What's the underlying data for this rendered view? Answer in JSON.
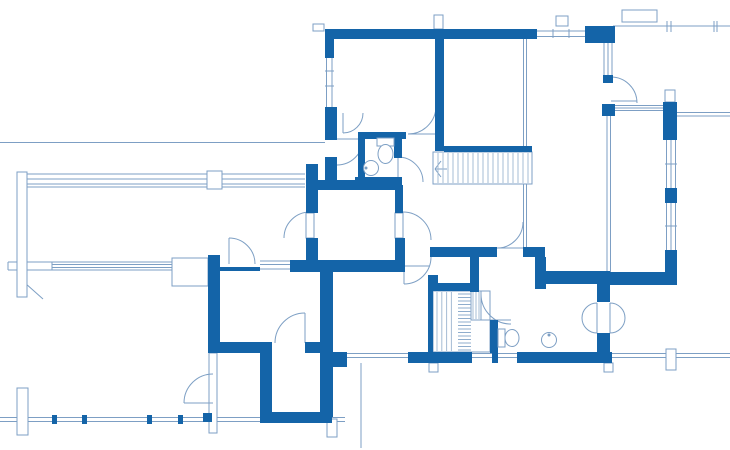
{
  "document": {
    "type": "architectural-floor-plan",
    "canvas": {
      "width": 730,
      "height": 450
    },
    "colors": {
      "background": "#ffffff",
      "wall": "#1464a8",
      "line": "#7d9fc4",
      "hatch": "#a5bcd4",
      "hatch_dense": "#8fadcd",
      "fixture": "#7d9fc4"
    }
  },
  "plan": {
    "walls": [
      [
        325,
        29,
        212,
        10
      ],
      [
        585,
        26,
        30,
        17
      ],
      [
        600,
        27,
        15,
        16
      ],
      [
        325,
        29,
        9,
        29
      ],
      [
        325,
        107,
        12,
        33
      ],
      [
        325,
        157,
        12,
        30
      ],
      [
        435,
        31,
        9,
        120
      ],
      [
        444,
        146,
        88,
        6
      ],
      [
        358,
        132,
        48,
        7
      ],
      [
        358,
        132,
        7,
        53
      ],
      [
        394,
        132,
        8,
        26
      ],
      [
        355,
        177,
        47,
        8
      ],
      [
        306,
        164,
        12,
        49
      ],
      [
        306,
        238,
        12,
        26
      ],
      [
        310,
        180,
        92,
        10
      ],
      [
        395,
        185,
        8,
        28
      ],
      [
        395,
        238,
        10,
        34
      ],
      [
        290,
        260,
        113,
        12
      ],
      [
        208,
        255,
        12,
        17
      ],
      [
        218,
        267,
        42,
        4
      ],
      [
        208,
        258,
        12,
        95
      ],
      [
        320,
        268,
        13,
        149
      ],
      [
        208,
        342,
        64,
        11
      ],
      [
        305,
        342,
        28,
        11
      ],
      [
        260,
        353,
        12,
        70
      ],
      [
        260,
        412,
        72,
        11
      ],
      [
        430,
        247,
        67,
        10
      ],
      [
        523,
        247,
        22,
        10
      ],
      [
        535,
        257,
        11,
        32
      ],
      [
        545,
        271,
        65,
        13
      ],
      [
        597,
        284,
        13,
        18
      ],
      [
        597,
        333,
        13,
        29
      ],
      [
        610,
        272,
        65,
        13
      ],
      [
        470,
        257,
        9,
        35
      ],
      [
        428,
        275,
        10,
        16
      ],
      [
        428,
        290,
        5,
        62
      ],
      [
        433,
        283,
        37,
        8
      ],
      [
        490,
        320,
        8,
        33
      ],
      [
        408,
        352,
        64,
        11
      ],
      [
        492,
        352,
        6,
        11
      ],
      [
        517,
        352,
        95,
        11
      ],
      [
        332,
        352,
        15,
        15
      ],
      [
        603,
        75,
        10,
        8
      ],
      [
        602,
        104,
        13,
        12
      ],
      [
        663,
        102,
        14,
        38
      ],
      [
        665,
        188,
        12,
        15
      ],
      [
        665,
        250,
        12,
        35
      ],
      [
        52,
        415,
        5,
        9
      ],
      [
        82,
        415,
        5,
        9
      ],
      [
        147,
        415,
        5,
        9
      ],
      [
        178,
        415,
        5,
        9
      ],
      [
        203,
        413,
        9,
        9
      ]
    ],
    "thin_lines": [
      [
        0,
        142.5,
        325,
        142.5
      ],
      [
        326.5,
        58,
        326.5,
        107
      ],
      [
        332,
        58,
        332,
        107
      ],
      [
        325,
        71,
        334,
        71
      ],
      [
        325,
        86,
        334,
        86
      ],
      [
        537,
        31,
        585,
        31
      ],
      [
        537,
        36.5,
        585,
        36.5
      ],
      [
        553,
        29,
        553,
        38
      ],
      [
        569,
        29,
        569,
        38
      ],
      [
        604,
        43,
        604,
        76
      ],
      [
        608,
        43,
        608,
        76
      ],
      [
        612,
        43,
        612,
        76
      ],
      [
        613,
        26,
        730,
        26
      ],
      [
        667,
        21,
        667,
        32
      ],
      [
        671,
        21,
        671,
        32
      ],
      [
        714,
        21,
        714,
        32
      ],
      [
        717,
        21,
        717,
        32
      ],
      [
        18,
        174,
        305,
        174
      ],
      [
        18,
        179,
        305,
        179
      ],
      [
        18,
        184,
        305,
        184
      ],
      [
        18,
        187,
        305,
        187
      ],
      [
        8,
        262,
        172,
        262
      ],
      [
        8,
        270,
        172,
        270
      ],
      [
        52,
        264.5,
        172,
        264.5
      ],
      [
        52,
        267.5,
        172,
        267.5
      ],
      [
        8,
        262,
        8,
        270
      ],
      [
        52,
        262,
        52,
        270
      ],
      [
        260,
        261,
        292,
        261
      ],
      [
        260,
        264.5,
        292,
        264.5
      ],
      [
        260,
        269,
        292,
        269
      ],
      [
        523.5,
        36,
        523.5,
        150
      ],
      [
        526.5,
        36,
        526.5,
        150
      ],
      [
        523.5,
        184,
        523.5,
        248
      ],
      [
        526.5,
        184,
        526.5,
        248
      ],
      [
        607,
        116,
        607,
        272
      ],
      [
        610.5,
        116,
        610.5,
        272
      ],
      [
        615,
        105.5,
        663,
        105.5
      ],
      [
        615,
        108,
        663,
        108
      ],
      [
        615,
        110.5,
        663,
        110.5
      ],
      [
        677,
        112.5,
        730,
        112.5
      ],
      [
        677,
        116,
        730,
        116
      ],
      [
        666.5,
        140,
        666.5,
        188
      ],
      [
        671,
        140,
        671,
        188
      ],
      [
        675.5,
        140,
        675.5,
        188
      ],
      [
        665,
        164,
        677,
        164
      ],
      [
        666.5,
        203,
        666.5,
        250
      ],
      [
        671,
        203,
        671,
        250
      ],
      [
        675.5,
        203,
        675.5,
        250
      ],
      [
        665,
        226,
        677,
        226
      ],
      [
        347,
        353.5,
        408,
        353.5
      ],
      [
        347,
        357.5,
        408,
        357.5
      ],
      [
        472,
        353.5,
        492,
        353.5
      ],
      [
        472,
        357.5,
        492,
        357.5
      ],
      [
        498,
        353.5,
        517,
        353.5
      ],
      [
        498,
        357.5,
        517,
        357.5
      ],
      [
        0,
        417.5,
        345,
        417.5
      ],
      [
        0,
        421.5,
        345,
        421.5
      ],
      [
        612,
        353.5,
        730,
        353.5
      ],
      [
        612,
        357.5,
        730,
        357.5
      ],
      [
        361,
        363,
        361,
        448
      ],
      [
        405,
        266,
        430,
        266
      ],
      [
        25,
        283,
        43,
        299
      ],
      [
        622,
        16,
        657,
        16
      ],
      [
        172,
        266,
        208,
        266
      ],
      [
        172,
        274,
        208,
        274
      ],
      [
        172,
        281,
        208,
        281
      ],
      [
        177,
        272,
        190,
        262
      ],
      [
        190,
        262,
        203,
        272
      ],
      [
        441,
        161,
        435,
        169
      ],
      [
        435,
        169,
        441,
        177
      ],
      [
        435,
        169,
        447,
        169
      ],
      [
        212,
        171,
        212,
        189
      ]
    ],
    "outline_boxes": [
      [
        17,
        172,
        10,
        125
      ],
      [
        207,
        171,
        15,
        18
      ],
      [
        17,
        388,
        11,
        47
      ],
      [
        327,
        419,
        10,
        18
      ],
      [
        429,
        363,
        9,
        9
      ],
      [
        604,
        363,
        9,
        9
      ],
      [
        666,
        349,
        10,
        21
      ],
      [
        434,
        15,
        9,
        14
      ],
      [
        313,
        24,
        11,
        7
      ],
      [
        622,
        10,
        35,
        12
      ],
      [
        172,
        258,
        36,
        28
      ],
      [
        209,
        353,
        8,
        80
      ],
      [
        665,
        90,
        10,
        12
      ],
      [
        556,
        16,
        12,
        10
      ],
      [
        306,
        213,
        8,
        25
      ],
      [
        395,
        213,
        8,
        25
      ]
    ],
    "doors": [
      {
        "arc": "M363,139 A26,26 0 0 1 337,165",
        "leaf": [
          337,
          139,
          363,
          139
        ]
      },
      {
        "arc": "M363,113 A20,20 0 0 1 343,133",
        "leaf": [
          343,
          113,
          343,
          133
        ]
      },
      {
        "arc": "M408,134 A28,28 0 0 0 436,106",
        "leaf": [
          408,
          134,
          436,
          134
        ]
      },
      {
        "arc": "M398,157 A25,25 0 0 1 423,182",
        "leaf": [
          398,
          157,
          398,
          182
        ]
      },
      {
        "arc": "M229,238 A26,26 0 0 1 255,264",
        "leaf": [
          229,
          238,
          229,
          264
        ]
      },
      {
        "arc": "M404,284 A27,27 0 0 0 431,257",
        "leaf": [
          404,
          257,
          404,
          284
        ]
      },
      {
        "arc": "M497,248 A26,26 0 0 0 523,222",
        "leaf": [
          497,
          248,
          523,
          248
        ]
      },
      {
        "arc": "M305,313 A30,30 0 0 0 275,343",
        "leaf": [
          305,
          313,
          305,
          343
        ]
      },
      {
        "arc": "M184,403 A29,29 0 0 1 213,374",
        "leaf": [
          184,
          403,
          213,
          403
        ]
      },
      {
        "arc": "M481,294 A30,30 0 0 0 511,324",
        "leaf": [
          481,
          320,
          511,
          320
        ]
      },
      {
        "arc": "M611,77 A26,26 0 0 1 637,103",
        "leaf": [
          611,
          101,
          637,
          101
        ]
      },
      {
        "arc": "M310,212 A26,26 0 0 0 284,238",
        "leaf": null
      },
      {
        "arc": "M403,212 A28,28 0 0 1 431,240",
        "leaf": null
      },
      {
        "arc": "M597,303 A15,15 0 0 0 597,333",
        "leaf": [
          597,
          303,
          597,
          333
        ]
      },
      {
        "arc": "M610,303 A15,15 0 0 1 610,333",
        "leaf": [
          610,
          303,
          610,
          333
        ]
      }
    ],
    "stairs": {
      "upper": {
        "outline": [
          433,
          152,
          99,
          32
        ],
        "treads": {
          "dir": "v",
          "from": 438,
          "to": 529,
          "step": 5,
          "a": 153,
          "b": 183
        }
      },
      "lower": {
        "outline": [
          433,
          291,
          57,
          61
        ],
        "subbox": [
          471,
          291,
          10,
          29
        ],
        "zones": [
          {
            "dir": "v",
            "from": 437,
            "to": 456,
            "step": 4.8,
            "a": 292,
            "b": 351,
            "tone": "hatch"
          },
          {
            "dir": "h",
            "from": 294,
            "to": 350,
            "step": 3.5,
            "a": 458,
            "b": 471,
            "tone": "hatch_dense"
          },
          {
            "dir": "v",
            "from": 473,
            "to": 480,
            "step": 3,
            "a": 292,
            "b": 319,
            "tone": "hatch"
          }
        ]
      }
    },
    "fixtures": {
      "toilets": [
        {
          "tank": [
            377,
            138,
            17,
            8
          ],
          "bowl": [
            385.5,
            154,
            7.5,
            9.5
          ]
        },
        {
          "tank": [
            498,
            329,
            7,
            18
          ],
          "bowl": [
            512,
            338,
            7,
            8.5
          ]
        }
      ],
      "sinks": [
        {
          "c": [
            371,
            168,
            7.5
          ],
          "dot": [
            366,
            168
          ]
        },
        {
          "c": [
            549,
            340,
            7.5
          ],
          "dot": [
            549,
            335
          ]
        }
      ]
    }
  }
}
